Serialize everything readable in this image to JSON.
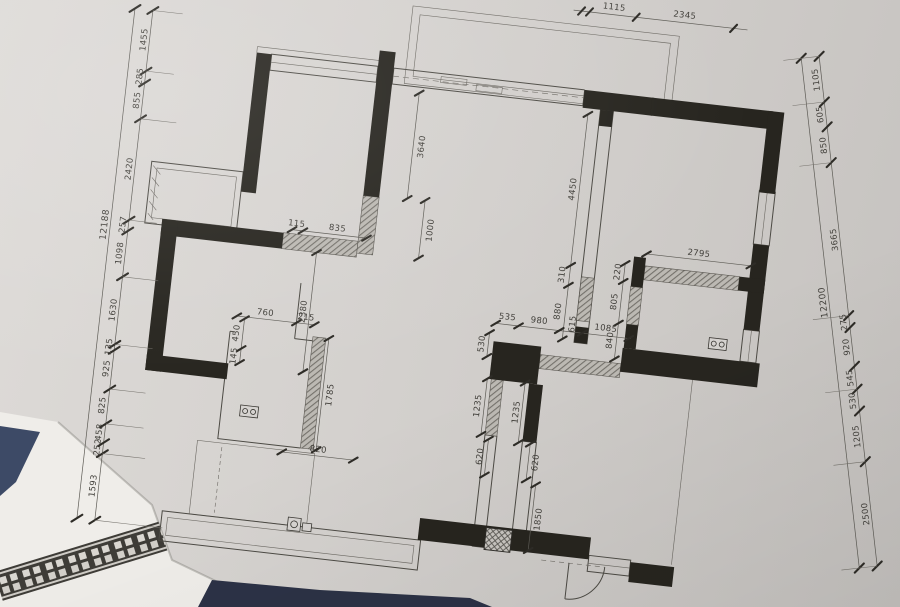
{
  "drawing_type": "apartment floor plan, dimensioned in millimetres",
  "colors": {
    "paper": "#d4d1ce",
    "ink": "#4c4a44",
    "wall_fill": "#27251f",
    "hatch_wall": "#bcb9b3",
    "white_sheet": "#efede9",
    "navy_fabric": "#3d4a66",
    "navy_table": "#2c3246"
  },
  "chains": {
    "left": {
      "overall": "12188",
      "segments": [
        "1455",
        "285",
        "855",
        "2420",
        "257",
        "1098",
        "1630",
        "135",
        "925",
        "825",
        "458",
        "252",
        "1593"
      ]
    },
    "right": {
      "overall": "12200",
      "segments": [
        "1105",
        "605",
        "850",
        "3665",
        "275",
        "920",
        "545",
        "530",
        "1205",
        "2500"
      ]
    },
    "top": {
      "segments": [
        "1115",
        "2345"
      ]
    }
  },
  "interior": {
    "living_wall_upper": "3640",
    "living_wall_lower": "1000",
    "b2_pier": "115",
    "b2_window": "835",
    "b1_depth": "2380",
    "living_right_wall": "4450",
    "corridor_a": "310",
    "corridor_b": "880",
    "study_width": "2795",
    "study_a": "220",
    "study_b": "805",
    "study_c": "840",
    "hall_a": "535",
    "hall_b": "980",
    "hall_c": "615",
    "hall_d": "1085",
    "hall_pier": "530",
    "bath2_a": "1235",
    "bath2_b": "1235",
    "wc_door": "760",
    "wc_pier": "215",
    "wc_a": "450",
    "wc_b": "145",
    "wc_depth": "1785",
    "wc_bottom": "820",
    "kit_a": "620",
    "kit_b": "620",
    "kit_depth": "1850"
  },
  "symbols": [
    "double-socket-symbol",
    "floor-drain-symbol",
    "flue-shaft-symbol",
    "door-swing-arc",
    "window-hatch-wall"
  ]
}
